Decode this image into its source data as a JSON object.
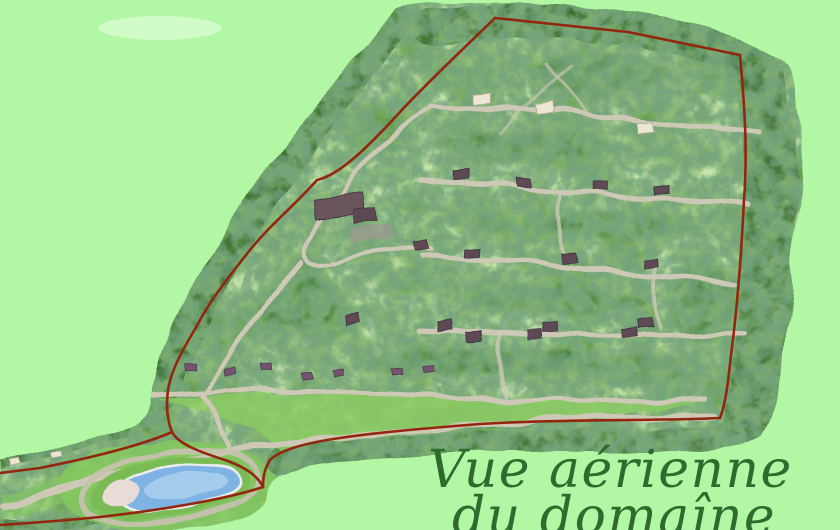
{
  "caption": {
    "line1": "Vue aérienne",
    "line2": "du domaîne"
  },
  "colors": {
    "background": "#b2f8a4",
    "boundary": "#93260f",
    "caption": "#2e6b2e",
    "photo_base": "#669f4b",
    "forest": "#39722f",
    "forest_deep": "#2a5a35",
    "grass_light": "#a7da77",
    "meadow": "#8ccd62",
    "road": "#cec8b6",
    "pool_water": "#7eb3e3",
    "pool_water_light": "#abceed",
    "pool_beach": "#e9dbd6",
    "roof_dark": "#5f4a55",
    "roof_small": "#745270",
    "roof_white": "#ece6d2"
  }
}
